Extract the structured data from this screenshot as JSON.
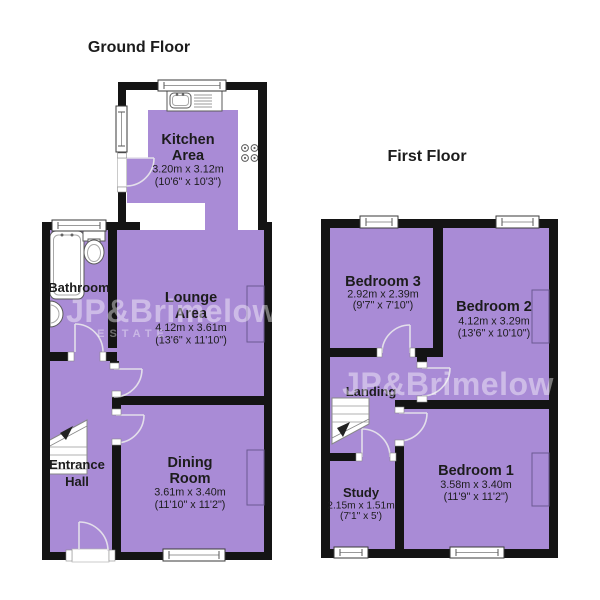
{
  "palette": {
    "room_fill": "#a98bd6",
    "wall": "#141414",
    "background": "#ffffff",
    "watermark": "#ffffff"
  },
  "ground_floor": {
    "title": "Ground Floor",
    "watermark": {
      "line1": "JP&Brimelow",
      "line2": "ESTATE"
    },
    "rooms": {
      "kitchen": {
        "name1": "Kitchen",
        "name2": "Area",
        "metric": "3.20m x 3.12m",
        "imperial": "(10'6\" x 10'3\")"
      },
      "bathroom": {
        "name1": "Bathroom"
      },
      "lounge": {
        "name1": "Lounge",
        "name2": "Area",
        "metric": "4.12m x 3.61m",
        "imperial": "(13'6\" x 11'10\")"
      },
      "entrance_hall": {
        "name1": "Entrance",
        "name2": "Hall"
      },
      "dining": {
        "name1": "Dining",
        "name2": "Room",
        "metric": "3.61m x 3.40m",
        "imperial": "(11'10\" x 11'2\")"
      }
    }
  },
  "first_floor": {
    "title": "First Floor",
    "watermark": {
      "line1": "JP&Brimelow"
    },
    "rooms": {
      "bedroom3": {
        "name1": "Bedroom 3",
        "metric": "2.92m x 2.39m",
        "imperial": "(9'7\" x 7'10\")"
      },
      "bedroom2": {
        "name1": "Bedroom 2",
        "metric": "4.12m x 3.29m",
        "imperial": "(13'6\" x 10'10\")"
      },
      "landing": {
        "name1": "Landing"
      },
      "bedroom1": {
        "name1": "Bedroom 1",
        "metric": "3.58m x 3.40m",
        "imperial": "(11'9\" x 11'2\")"
      },
      "study": {
        "name1": "Study",
        "metric": "2.15m x 1.51m",
        "imperial": "(7'1\" x 5')"
      }
    }
  }
}
